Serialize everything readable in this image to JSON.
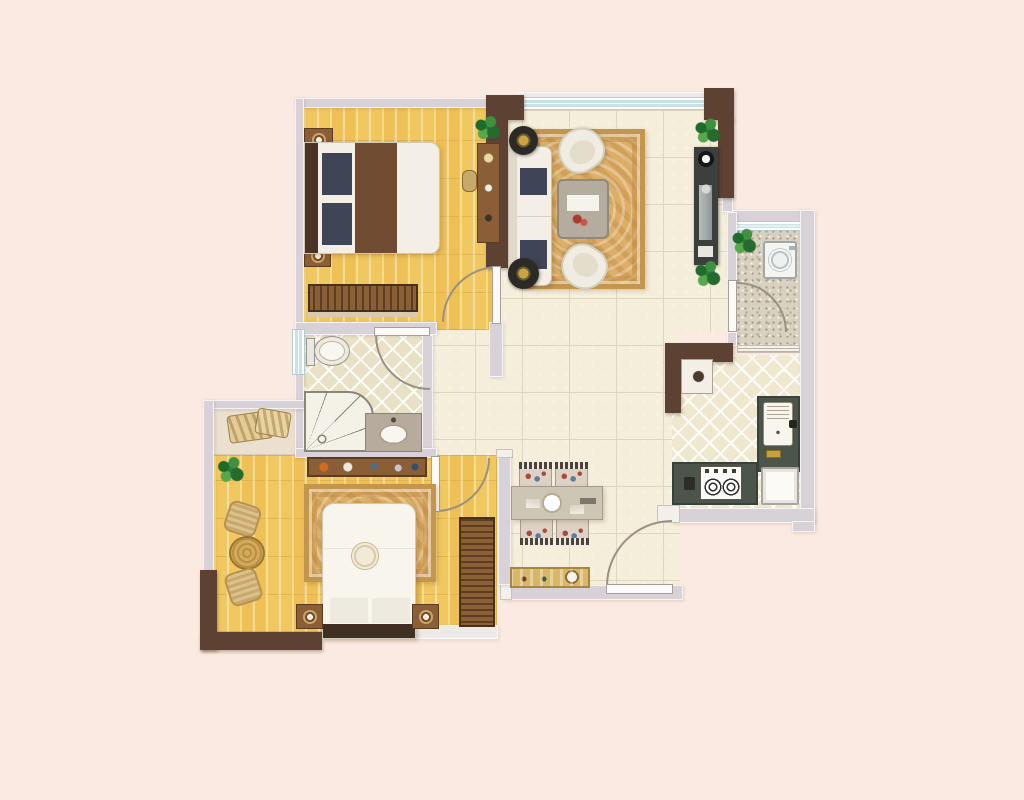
{
  "meta": {
    "type": "apartment-floor-plan",
    "description": "Color architectural floor plan of a two-bedroom apartment, top-down view, no text labels"
  },
  "colors": {
    "bg": "#fbeae1",
    "wall": "#d8d2d8",
    "wall-light": "#eceae8",
    "wall-brown": "#5d4233",
    "window-glass": "#c9e2e3",
    "wood-floor": "#f1c75f",
    "tile-floor": "#f4eedb",
    "tile-line": "#ded7c0",
    "diamond-floor": "#e9e1c6",
    "kitchen-floor": "#efe8cf",
    "speckle-floor": "#d8d1bf",
    "counter": "#4b5549",
    "tv-cabinet": "#3b403c",
    "rug": "#dcae67",
    "rug-border": "#c4964d",
    "furniture-white": "#f3efe6",
    "cushion-dark": "#3f4456",
    "furniture-wood": "#8a5e36",
    "bed-runner": "#6f4c32",
    "plant-green": "#2d7c35",
    "dining-gold": "#d8b768"
  },
  "rooms": [
    {
      "id": "bedroom-1",
      "floor": "wood-plank",
      "furniture": [
        "double-bed",
        "nightstand",
        "nightstand",
        "wardrobe",
        "desk",
        "stool",
        "plant"
      ]
    },
    {
      "id": "living-room",
      "floor": "ceramic-tile",
      "furniture": [
        "sofa",
        "armchair",
        "armchair",
        "side-table",
        "side-table",
        "coffee-table",
        "rug",
        "tv-cabinet",
        "plant",
        "plant"
      ]
    },
    {
      "id": "laundry-balcony",
      "floor": "speckled-stone",
      "furniture": [
        "washing-machine",
        "plant"
      ]
    },
    {
      "id": "kitchen",
      "floor": "diamond-tile",
      "furniture": [
        "l-counter",
        "sink",
        "gas-stove",
        "fridge",
        "small-cabinet"
      ]
    },
    {
      "id": "dining-area",
      "floor": "ceramic-tile",
      "furniture": [
        "dining-table",
        "chair",
        "chair",
        "chair",
        "chair",
        "sideboard"
      ]
    },
    {
      "id": "bathroom",
      "floor": "diamond-tile",
      "furniture": [
        "toilet",
        "shower",
        "washbasin"
      ]
    },
    {
      "id": "bedroom-2",
      "floor": "wood-plank",
      "furniture": [
        "double-bed",
        "nightstand",
        "nightstand",
        "dresser",
        "wardrobe",
        "rug",
        "wicker-chair",
        "wicker-chair",
        "round-table",
        "plant",
        "bay-window-cushions"
      ]
    }
  ],
  "doors": [
    "bedroom-1-door",
    "bathroom-door",
    "bedroom-2-door",
    "laundry-door",
    "entry-door"
  ],
  "windows": [
    "living-room-top-window",
    "laundry-top-window",
    "laundry-kitchen-pass-window",
    "bathroom-left-window",
    "bay-window"
  ]
}
